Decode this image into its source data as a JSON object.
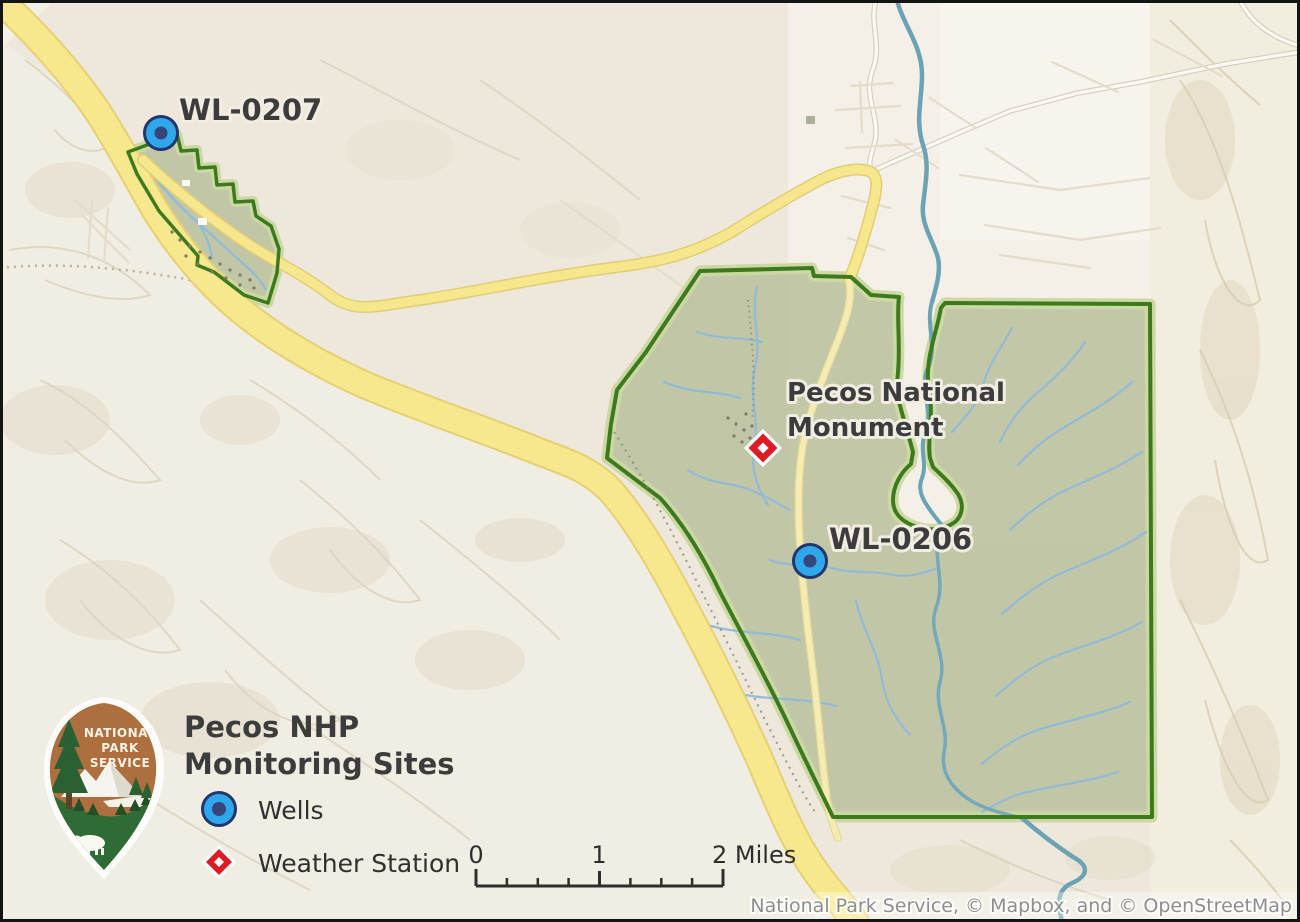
{
  "map": {
    "labels": {
      "well_207": "WL-0207",
      "well_206": "WL-0206",
      "monument_line1": "Pecos National",
      "monument_line2": "Monument"
    },
    "markers": [
      {
        "id": "WL-0207",
        "type": "well"
      },
      {
        "id": "WL-0206",
        "type": "well"
      },
      {
        "id": "Pecos National Monument",
        "type": "weather-station"
      }
    ]
  },
  "legend": {
    "title_line1": "Pecos NHP",
    "title_line2": "Monitoring Sites",
    "items": [
      {
        "label": "Wells",
        "symbol": "well-circle-icon"
      },
      {
        "label": "Weather Station",
        "symbol": "weather-diamond-icon"
      }
    ]
  },
  "logo": {
    "line1": "NATIONAL",
    "line2": "PARK",
    "line3": "SERVICE"
  },
  "scalebar": {
    "tick0_label": "0",
    "tick1_label": "1",
    "tick2_label": "2 Miles"
  },
  "attribution": "National Park Service, © Mapbox, and © OpenStreetMap",
  "colors": {
    "background": "#EDE8DB",
    "park_fill": "#BFC4A5",
    "park_border": "#3C7A1D",
    "highway_yellow": "#F7E88D",
    "river_teal": "#6BA2B4",
    "stream_blue": "#8FB9D9",
    "well_fill": "#2FA8EB",
    "well_core": "#374679",
    "weather_red": "#DE1B22",
    "label_text": "#3C3C3C",
    "attribution_text": "#8E8E8E",
    "logo_brown": "#AD6F3D",
    "logo_green": "#2F6B35"
  }
}
